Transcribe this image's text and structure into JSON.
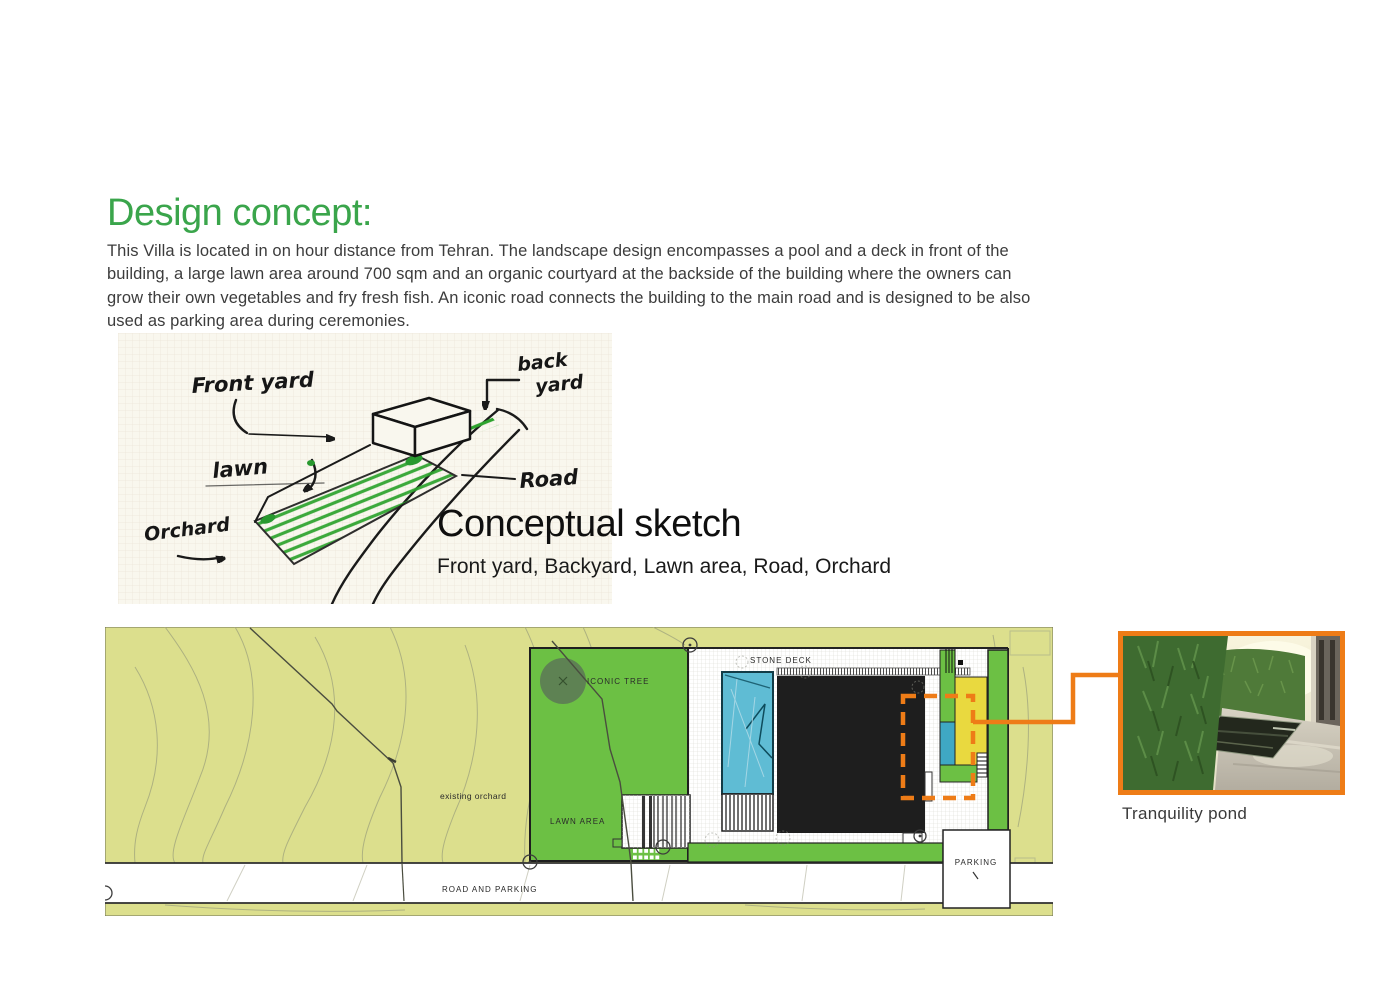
{
  "document": {
    "title": "Design concept:",
    "intro": "This Villa is located in on hour distance from Tehran. The landscape design encompasses a pool and a deck in front of the building, a large lawn area around 700 sqm and an organic courtyard at the backside of the building where the owners can grow their own vegetables and fry fresh fish. An iconic road connects the building to the main road and is designed to be also used as parking area during ceremonies."
  },
  "sketch": {
    "heading": "Conceptual sketch",
    "subheading": "Front yard, Backyard, Lawn area, Road, Orchard",
    "labels": {
      "front_yard": "Front yard",
      "back_line1": "back",
      "back_line2": "yard",
      "lawn": "lawn",
      "road": "Road",
      "orchard": "Orchard"
    }
  },
  "site_plan": {
    "labels": {
      "stone_deck": "STONE DECK",
      "iconic_tree": "ICONIC TREE",
      "existing_orchard": "existing orchard",
      "lawn_area": "LAWN AREA",
      "road_and_parking": "ROAD AND PARKING",
      "parking": "PARKING"
    },
    "colors": {
      "field": "#dcdf8d",
      "lawn_green": "#6cc044",
      "tree_green": "#5e7e54",
      "pool_blue": "#5fbcd4",
      "courtyard_blue": "#3fa8c4",
      "building_black": "#1e1e1e",
      "courtyard_yellow": "#e9d93f",
      "highlight_orange": "#ee7c17"
    }
  },
  "photo": {
    "caption": "Tranquility pond"
  }
}
